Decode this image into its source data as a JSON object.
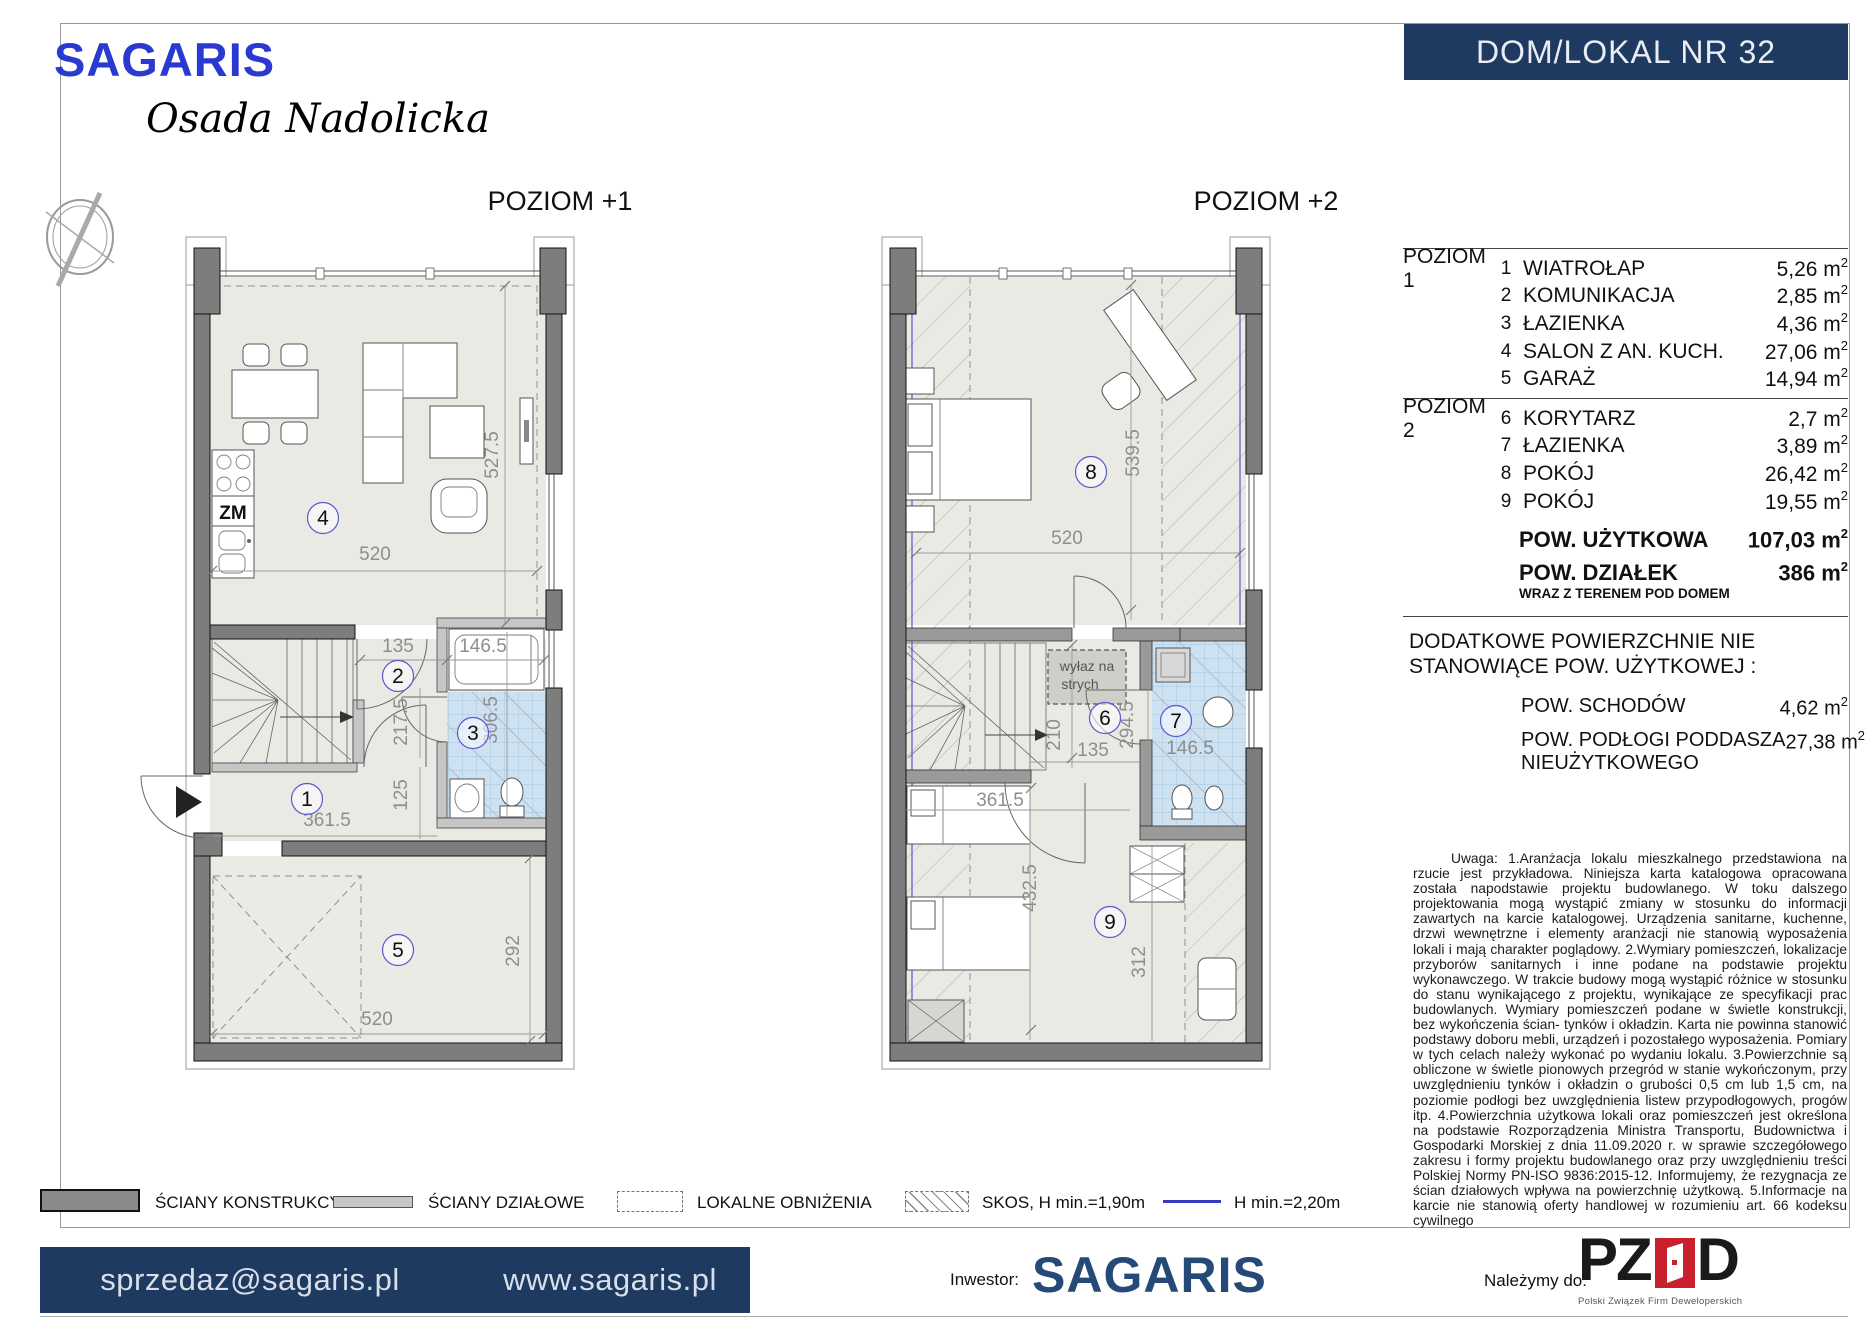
{
  "header": {
    "brand": "SAGARIS",
    "estate": "Osada Nadolicka",
    "unit": "DOM/LOKAL NR 32"
  },
  "colors": {
    "navy": "#1e3a60",
    "brand_blue": "#2a3ad0",
    "footer_navy": "#254a78",
    "pzfd_red": "#c8202c",
    "hmin_blue": "#3a3ac0"
  },
  "plans": {
    "plan1": {
      "title": "POZIOM +1",
      "markers": [
        {
          "n": "4",
          "x": 323,
          "y": 518
        },
        {
          "n": "2",
          "x": 398,
          "y": 676
        },
        {
          "n": "3",
          "x": 473,
          "y": 733
        },
        {
          "n": "1",
          "x": 307,
          "y": 799
        },
        {
          "n": "5",
          "x": 398,
          "y": 950
        }
      ],
      "dims": [
        {
          "t": "520",
          "x": 375,
          "y": 560
        },
        {
          "t": "527.5",
          "x": 498,
          "y": 455,
          "r": -90
        },
        {
          "t": "135",
          "x": 398,
          "y": 652
        },
        {
          "t": "146.5",
          "x": 483,
          "y": 652
        },
        {
          "t": "217.5",
          "x": 407,
          "y": 722,
          "r": -90
        },
        {
          "t": "306.5",
          "x": 497,
          "y": 720,
          "r": -90
        },
        {
          "t": "125",
          "x": 407,
          "y": 795,
          "r": -90
        },
        {
          "t": "361.5",
          "x": 327,
          "y": 826
        },
        {
          "t": "292",
          "x": 519,
          "y": 951,
          "r": -90
        },
        {
          "t": "520",
          "x": 377,
          "y": 1025
        }
      ],
      "texts": [
        {
          "t": "ZM",
          "x": 233,
          "y": 519,
          "s": 19,
          "b": true,
          "c": "#111"
        }
      ]
    },
    "plan2": {
      "title": "POZIOM +2",
      "markers": [
        {
          "n": "8",
          "x": 1091,
          "y": 472
        },
        {
          "n": "6",
          "x": 1105,
          "y": 718
        },
        {
          "n": "7",
          "x": 1176,
          "y": 721
        },
        {
          "n": "9",
          "x": 1110,
          "y": 922
        }
      ],
      "dims": [
        {
          "t": "520",
          "x": 1067,
          "y": 544
        },
        {
          "t": "539.5",
          "x": 1139,
          "y": 453,
          "r": -90
        },
        {
          "t": "210",
          "x": 1060,
          "y": 735,
          "r": -90
        },
        {
          "t": "135",
          "x": 1093,
          "y": 756
        },
        {
          "t": "294.5",
          "x": 1133,
          "y": 725,
          "r": -90
        },
        {
          "t": "146.5",
          "x": 1190,
          "y": 754
        },
        {
          "t": "361.5",
          "x": 1000,
          "y": 806
        },
        {
          "t": "432.5",
          "x": 1036,
          "y": 888,
          "r": -90
        },
        {
          "t": "312",
          "x": 1145,
          "y": 962,
          "r": -90
        }
      ],
      "texts": [
        {
          "t": "wyłaz na",
          "x": 1087,
          "y": 671,
          "s": 14,
          "c": "#555"
        },
        {
          "t": "strych",
          "x": 1080,
          "y": 689,
          "s": 14,
          "c": "#555"
        }
      ]
    }
  },
  "area_table": {
    "unit_prefix": " m",
    "unit_sup": "2",
    "levels": [
      {
        "label": "POZIOM 1",
        "rows": [
          {
            "no": "1",
            "name": "WIATROŁAP",
            "value": "5,26"
          },
          {
            "no": "2",
            "name": "KOMUNIKACJA",
            "value": "2,85"
          },
          {
            "no": "3",
            "name": "ŁAZIENKA",
            "value": "4,36"
          },
          {
            "no": "4",
            "name": "SALON Z AN. KUCH.",
            "value": "27,06"
          },
          {
            "no": "5",
            "name": "GARAŻ",
            "value": "14,94"
          }
        ]
      },
      {
        "label": "POZIOM 2",
        "rows": [
          {
            "no": "6",
            "name": "KORYTARZ",
            "value": "2,7"
          },
          {
            "no": "7",
            "name": "ŁAZIENKA",
            "value": "3,89"
          },
          {
            "no": "8",
            "name": "POKÓJ",
            "value": "26,42"
          },
          {
            "no": "9",
            "name": "POKÓJ",
            "value": "19,55"
          }
        ]
      }
    ],
    "totals": [
      {
        "label": "POW. UŻYTKOWA",
        "value": "107,03",
        "sub": ""
      },
      {
        "label": "POW. DZIAŁEK",
        "value": "386",
        "sub": "WRAZ Z TERENEM POD DOMEM"
      }
    ]
  },
  "additional": {
    "heading_line1": "DODATKOWE POWIERZCHNIE NIE",
    "heading_line2": "STANOWIĄCE POW. UŻYTKOWEJ :",
    "rows": [
      {
        "label_line1": "POW. SCHODÓW",
        "label_line2": "",
        "value": "4,62"
      },
      {
        "label_line1": "POW. PODŁOGI PODDASZA",
        "label_line2": "NIEUŻYTKOWEGO",
        "value": "27,38"
      }
    ]
  },
  "disclaimer": "Uwaga: 1.Aranżacja lokalu mieszkalnego przedstawiona na rzucie jest przykładowa. Niniejsza karta katalogowa opracowana została napodstawie projektu budowlanego. W toku dalszego projektowania mogą wystąpić zmiany w stosunku do informacji zawartych na karcie katalogowej. Urządzenia sanitarne, kuchenne, drzwi wewnętrzne i elementy aranżacji nie stanowią wyposażenia lokali i mają charakter poglądowy. 2.Wymiary pomieszczeń, lokalizacje przyborów sanitarnych i inne podane na podstawie projektu wykonawczego. W trakcie budowy mogą wystąpić różnice w stosunku do stanu wynikającego z projektu, wynikające ze specyfikacji prac budowlanych. Wymiary pomieszczeń podane w świetle konstrukcji, bez wykończenia ścian- tynków i okładzin. Karta nie powinna stanowić podstawy doboru mebli, urządzeń i pozostałego wyposażenia. Pomiary w tych celach należy wykonać po wydaniu lokalu. 3.Powierzchnie są obliczone w świetle pionowych przegród w stanie wykończonym, przy uwzględnieniu tynków i okładzin o grubości 0,5 cm lub 1,5 cm, na poziomie podłogi bez uwzględnienia listew przypodłogowych, progów itp. 4.Powierzchnia użytkowa lokali oraz pomieszczeń jest określona na podstawie Rozporządzenia Ministra Transportu, Budownictwa i Gospodarki Morskiej z dnia 11.09.2020 r. w sprawie szczegółowego zakresu i formy projektu budowlanego oraz przy uwzględnieniu treści Polskiej Normy PN-ISO 9836:2015-12. Informujemy, że rezygnacja ze ścian działowych wpływa na powierzchnię użytkową. 5.Informacje na karcie nie stanowią oferty handlowej w rozumieniu art. 66 kodeksu cywilnego",
  "legend": {
    "items": [
      {
        "label": "ŚCIANY KONSTRUKCYJNE"
      },
      {
        "label": "ŚCIANY DZIAŁOWE"
      },
      {
        "label": "LOKALNE OBNIŻENIA"
      },
      {
        "label": "SKOS, H min.=1,90m"
      },
      {
        "label": "H min.=2,20m"
      }
    ]
  },
  "footer": {
    "email": "sprzedaz@sagaris.pl",
    "website": "www.sagaris.pl",
    "investor_label": "Inwestor:",
    "investor_name": "SAGARIS",
    "member_label": "Należymy do:",
    "pzfd_letters_left": "PZ",
    "pzfd_letters_right": "D",
    "pzfd_caption": "Polski Związek Firm Deweloperskich"
  }
}
